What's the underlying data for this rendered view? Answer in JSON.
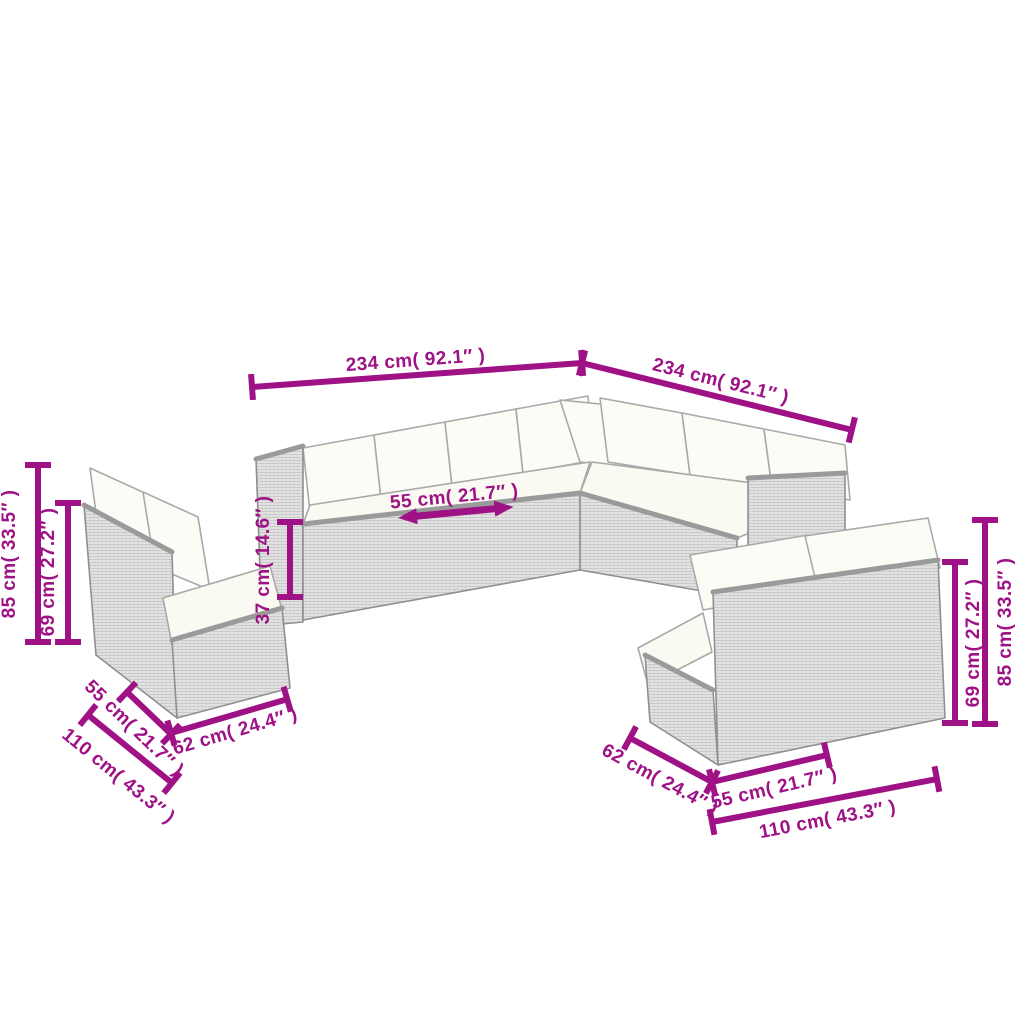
{
  "diagram": {
    "type": "furniture-dimension-diagram",
    "subject": "rattan garden lounge set with cushions (corner sofa and two loveseats)",
    "background": "#ffffff"
  },
  "colors": {
    "dimension_magenta": "#9e1285",
    "wicker_gray": "#e5e5e5",
    "outline_gray": "#8f8f8f",
    "cushion_white": "#fcfcf7"
  },
  "dimensions": {
    "corner_top_width": "234 cm( 92.1″ )",
    "corner_right_width": "234 cm( 92.1″ )",
    "center_seat_width": "55 cm( 21.7″ )",
    "seat_height": "37 cm( 14.6″ )",
    "left_total_height": "85 cm( 33.5″ )",
    "left_back_height": "69 cm( 27.2″ )",
    "left_seat_width": "55 cm( 21.7″ )",
    "left_depth": "62 cm( 24.4″ )",
    "left_total_width": "110 cm( 43.3″ )",
    "right_depth": "62 cm( 24.4″ )",
    "right_seat_width": "55 cm( 21.7″ )",
    "right_total_width": "110 cm( 43.3″ )",
    "right_back_height": "69 cm( 27.2″ )",
    "right_total_height": "85 cm( 33.5″ )"
  }
}
